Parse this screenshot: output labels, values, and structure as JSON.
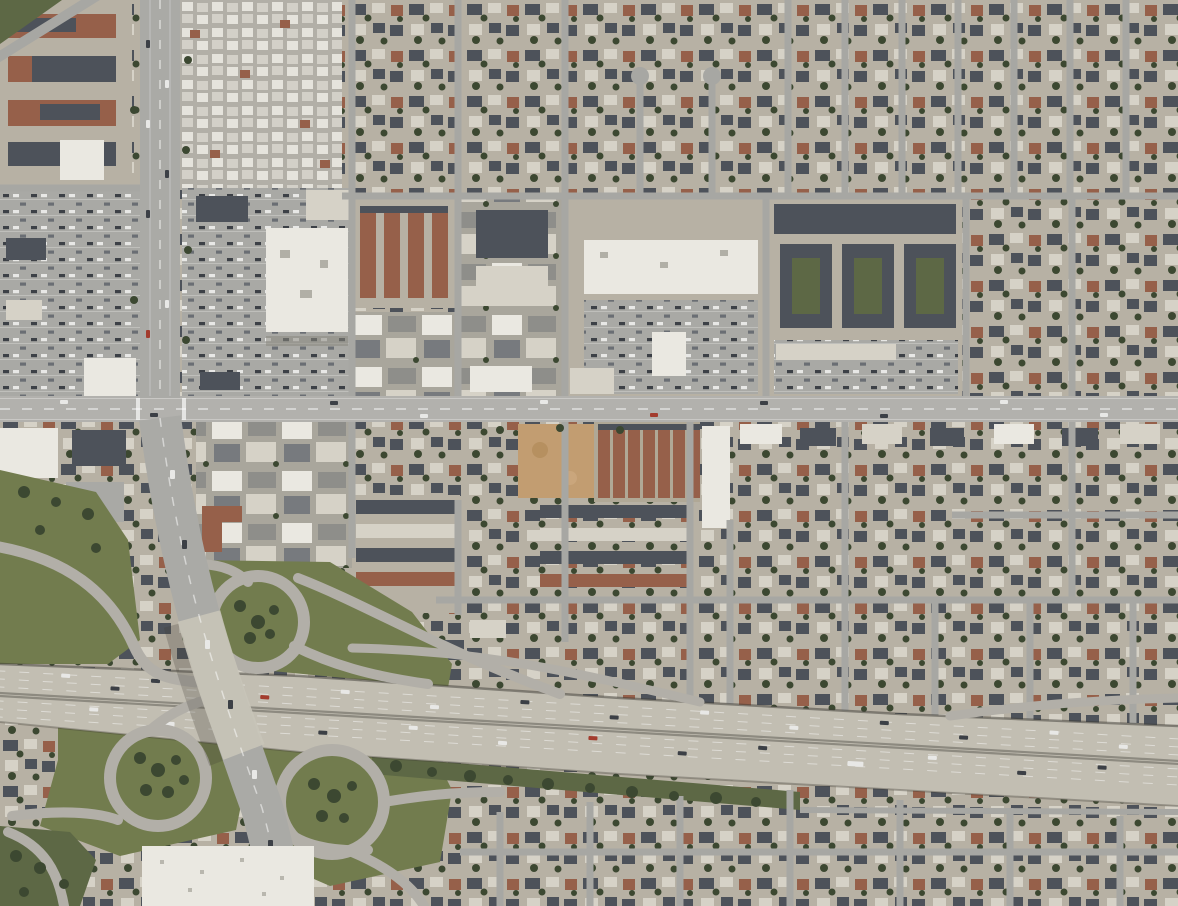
{
  "colors": {
    "urban_base": "#b7b1a4",
    "residential_roof_dark": "#4d525a",
    "residential_roof_brown": "#96604a",
    "residential_roof_light": "#d6d2c7",
    "white_roof": "#eae8e1",
    "tree_dark": "#3c4831",
    "grass": "#727c4e",
    "grass_dark": "#5d6845",
    "dirt_lot": "#c29d71",
    "street": "#a7a7a3",
    "arterial": "#b2b1ad",
    "boulevard": "#aaaaa6",
    "freeway_pavement": "#c2beb2",
    "freeway_median": "#8d8a80",
    "lane_marking": "#ffffff",
    "ramp": "#b2afa8",
    "parking_lot": "#a9a9a5",
    "mobile_home_light": "#e5e3dc",
    "mobile_home_mid": "#d3d0c8",
    "shadow": "#3e3c35",
    "car_dark": "#3c4046",
    "car_white": "#e8e8e6",
    "car_red": "#a33c2e"
  }
}
